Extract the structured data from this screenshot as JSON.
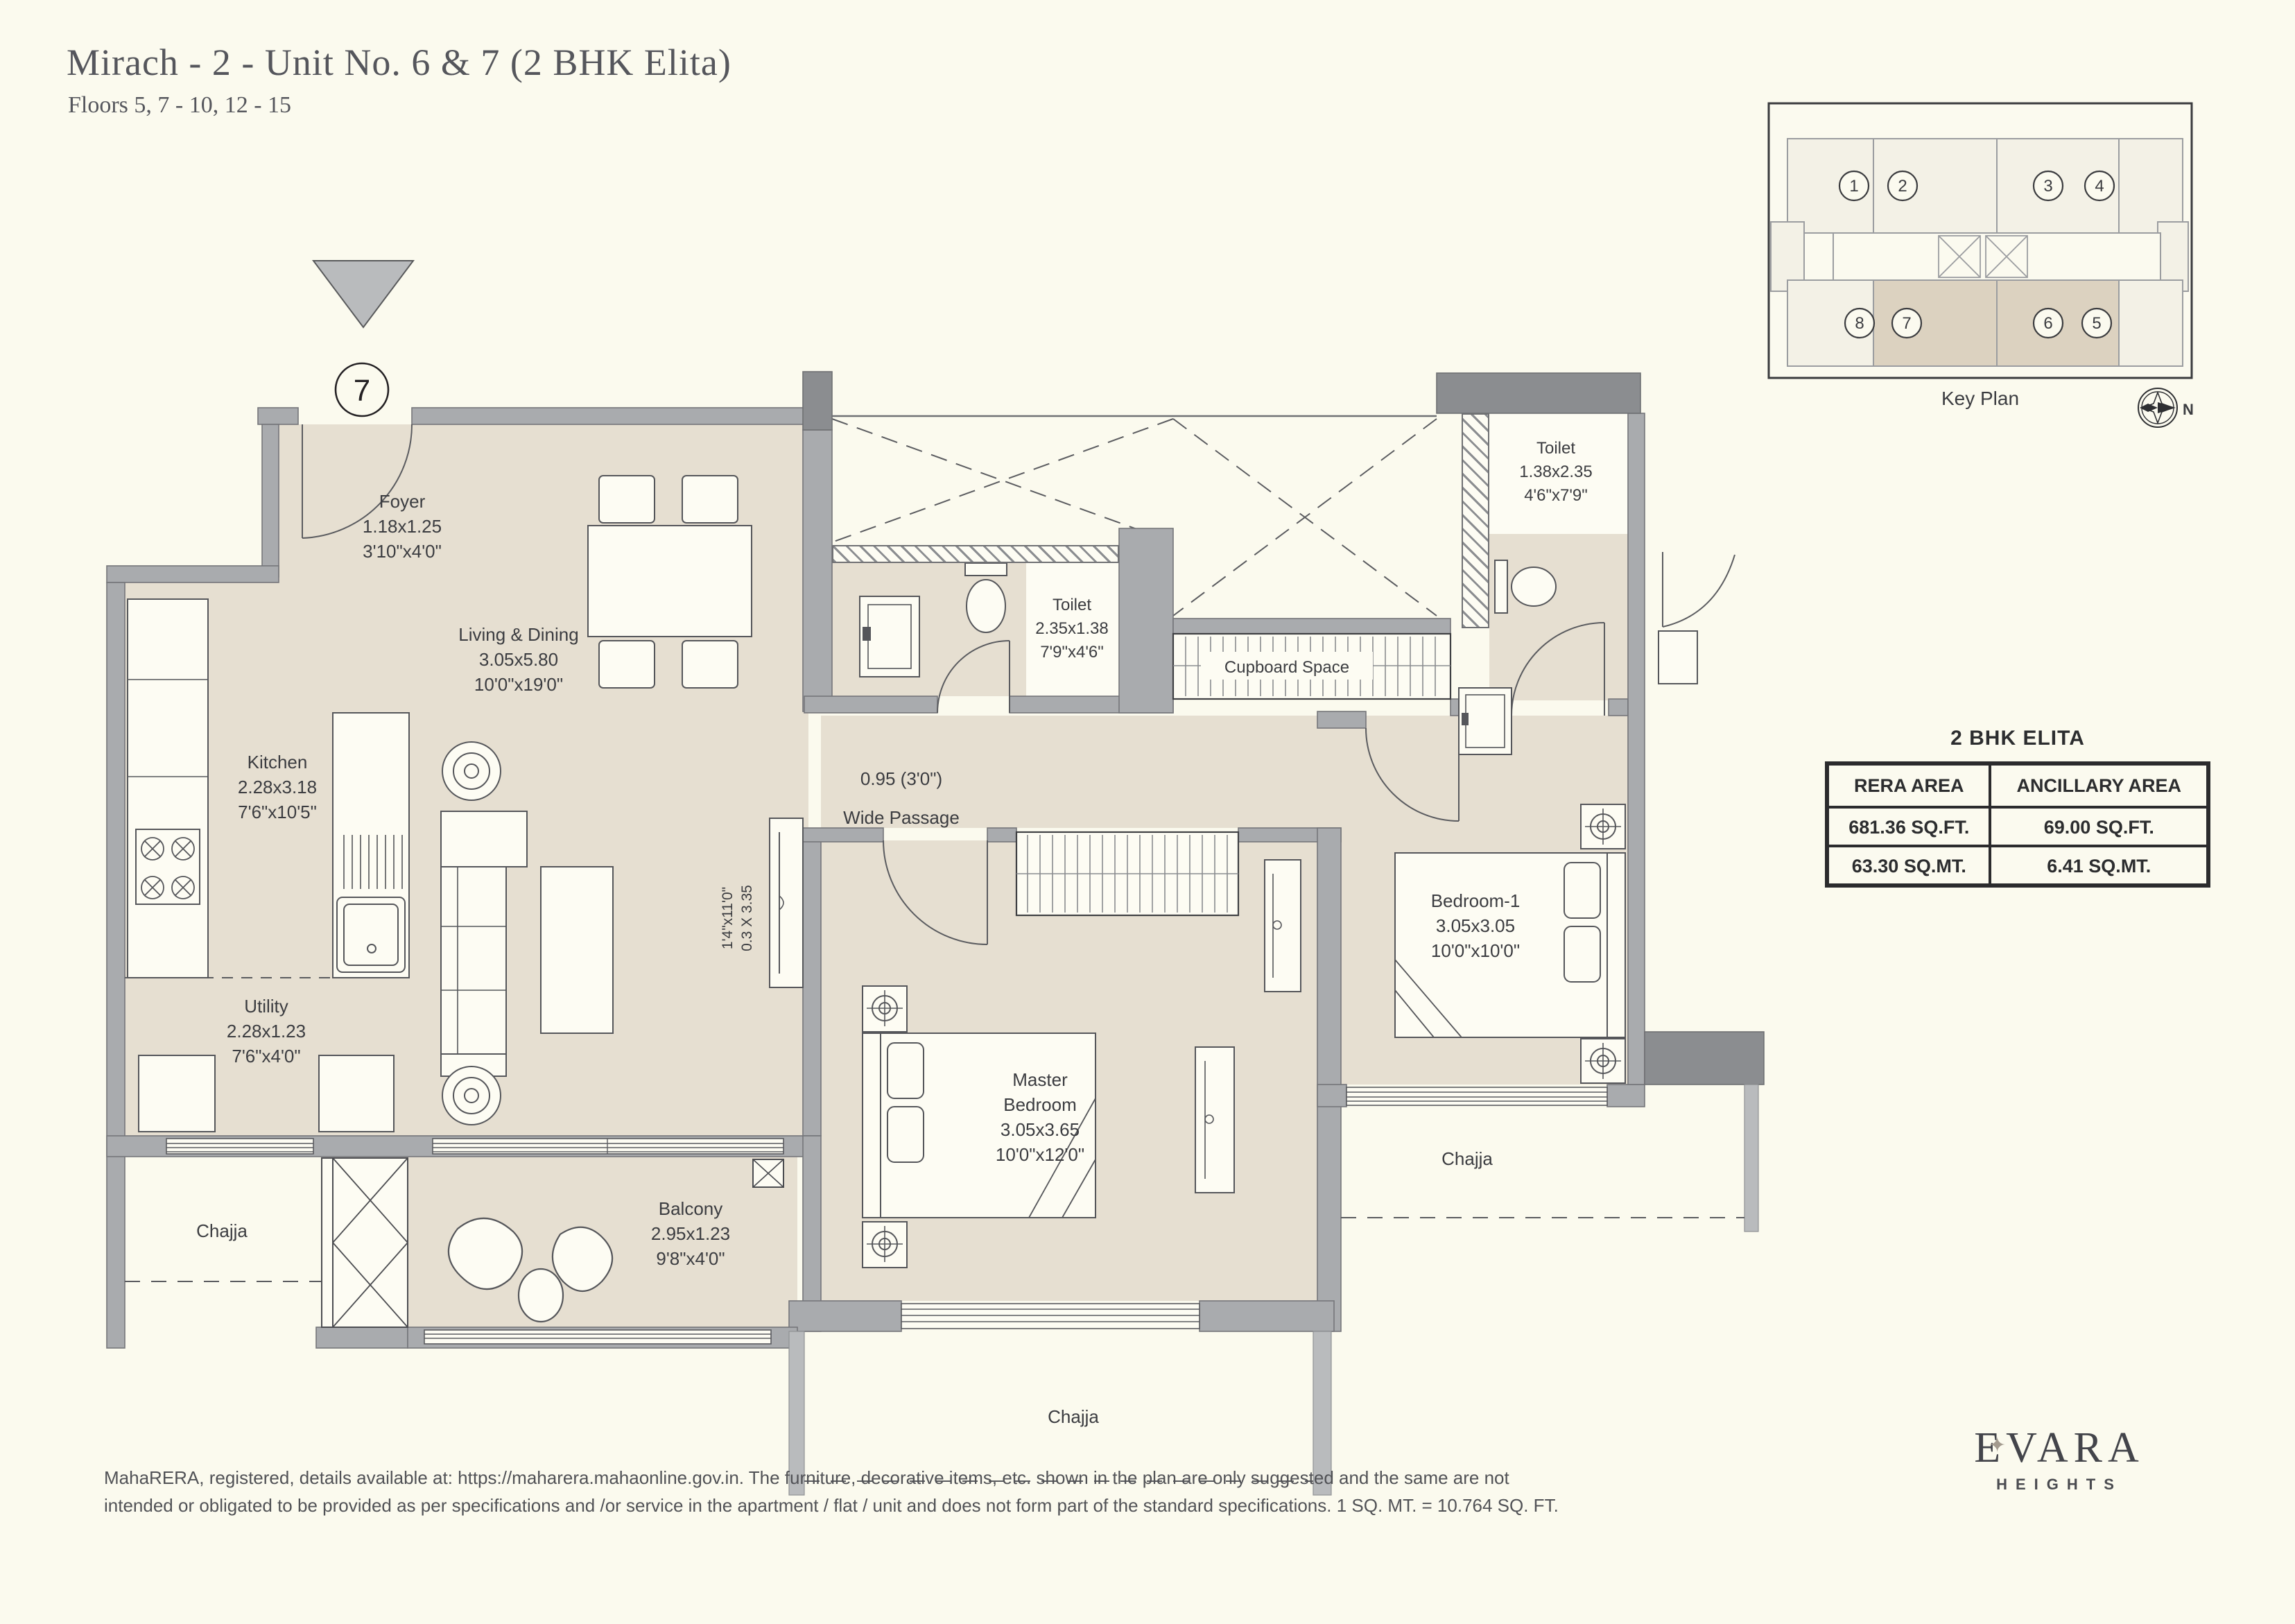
{
  "header": {
    "title": "Mirach - 2 - Unit No. 6 & 7 (2 BHK Elita)",
    "floors": "Floors 5, 7 - 10, 12 - 15"
  },
  "unit_marker": {
    "number": "7"
  },
  "key_plan": {
    "label": "Key Plan",
    "compass_n": "N",
    "unit_numbers": [
      "1",
      "2",
      "3",
      "4",
      "8",
      "7",
      "6",
      "5"
    ]
  },
  "area_table": {
    "title": "2 BHK ELITA",
    "headers": [
      "RERA AREA",
      "ANCILLARY AREA"
    ],
    "rows": [
      [
        "681.36 SQ.FT.",
        "69.00 SQ.FT."
      ],
      [
        "63.30 SQ.MT.",
        "6.41 SQ.MT."
      ]
    ]
  },
  "rooms": {
    "foyer": {
      "name": "Foyer",
      "dim_m": "1.18x1.25",
      "dim_ft": "3'10\"x4'0\""
    },
    "living": {
      "name": "Living & Dining",
      "dim_m": "3.05x5.80",
      "dim_ft": "10'0\"x19'0\""
    },
    "kitchen": {
      "name": "Kitchen",
      "dim_m": "2.28x3.18",
      "dim_ft": "7'6\"x10'5\""
    },
    "utility": {
      "name": "Utility",
      "dim_m": "2.28x1.23",
      "dim_ft": "7'6\"x4'0\""
    },
    "toilet_mid": {
      "name": "Toilet",
      "dim_m": "2.35x1.38",
      "dim_ft": "7'9\"x4'6\""
    },
    "toilet_top": {
      "name": "Toilet",
      "dim_m": "1.38x2.35",
      "dim_ft": "4'6\"x7'9\""
    },
    "cupboard": {
      "name": "Cupboard Space"
    },
    "passage": {
      "width": "0.95 (3'0\")",
      "name": "Wide Passage"
    },
    "master": {
      "name_line1": "Master",
      "name_line2": "Bedroom",
      "dim_m": "3.05x3.65",
      "dim_ft": "10'0\"x12'0\""
    },
    "bedroom1": {
      "name": "Bedroom-1",
      "dim_m": "3.05x3.05",
      "dim_ft": "10'0\"x10'0\""
    },
    "balcony": {
      "name": "Balcony",
      "dim_m": "2.95x1.23",
      "dim_ft": "9'8\"x4'0\""
    },
    "chajja_left": {
      "name": "Chajja"
    },
    "chajja_bottom": {
      "name": "Chajja"
    },
    "chajja_right": {
      "name": "Chajja"
    },
    "niche": {
      "dim_ft": "1'4\"x11'0\"",
      "dim_m": "0.3 X 3.35"
    }
  },
  "footer": {
    "disclaimer_line1": "MahaRERA, registered, details available at: https://maharera.mahaonline.gov.in. The furniture, decorative items, etc. shown in the plan are only suggested and the same are not",
    "disclaimer_line2": "intended or obligated to be provided as per specifications and /or service in the apartment / flat / unit and does not form part of the standard specifications. 1 SQ. MT. = 10.764 SQ. FT.",
    "logo_brand": "EVARA",
    "logo_sub": "HEIGHTS",
    "logo_star": "✦"
  }
}
